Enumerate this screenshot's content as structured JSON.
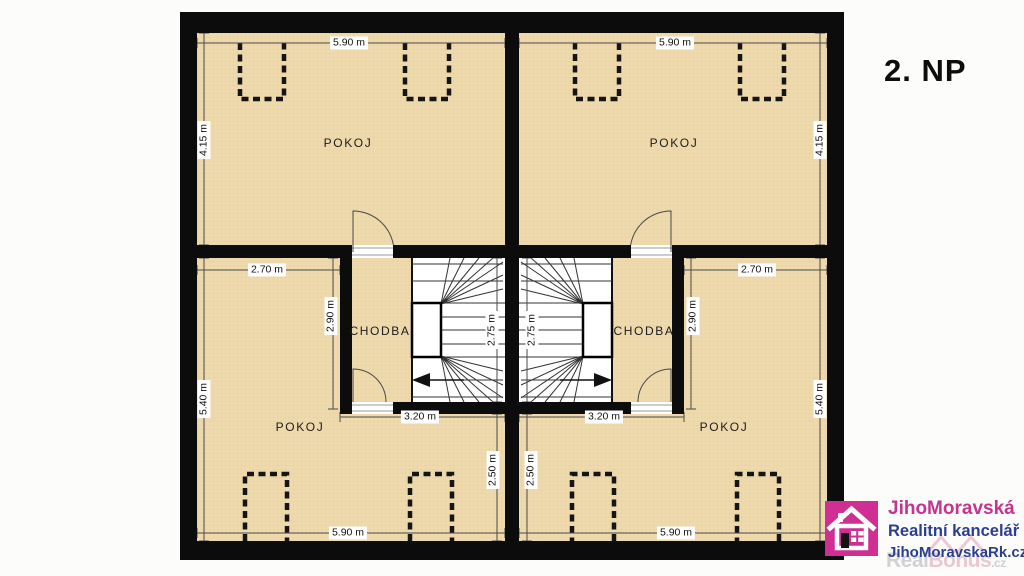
{
  "plan": {
    "title": "2. NP",
    "rooms": {
      "top_left": "POKOJ",
      "top_right": "POKOJ",
      "hall_left": "CHODBA",
      "hall_right": "CHODBA",
      "bottom_left": "POKOJ",
      "bottom_right": "POKOJ"
    },
    "dims": {
      "left": {
        "top_width": "5.90 m",
        "room_height": "4.15 m",
        "lower_room_width": "2.70 m",
        "lower_room_upper_height": "2.90 m",
        "lower_room_height": "5.40 m",
        "stair_depth": "2.75 m",
        "stair_width": "3.20 m",
        "lower_room_lower_height": "2.50 m",
        "bottom_width": "5.90 m"
      },
      "right": {
        "top_width": "5.90 m",
        "room_height": "4.15 m",
        "lower_room_width": "2.70 m",
        "lower_room_upper_height": "2.90 m",
        "lower_room_height": "5.40 m",
        "stair_depth": "2.75 m",
        "stair_width": "3.20 m",
        "lower_room_lower_height": "2.50 m",
        "bottom_width": "5.90 m"
      }
    },
    "colors": {
      "floor": "#eed9ad",
      "wall": "#0c0c0c"
    }
  },
  "branding": {
    "company": "JihoMoravská",
    "subtitle": "Realitní kancelář",
    "website": "JihoMoravskaRk.cz",
    "watermark_real": "Real",
    "watermark_bonus": "Bonus",
    "watermark_tld": ".cz",
    "accent_pink": "#cf2f92",
    "accent_blue": "#2b3f92"
  }
}
